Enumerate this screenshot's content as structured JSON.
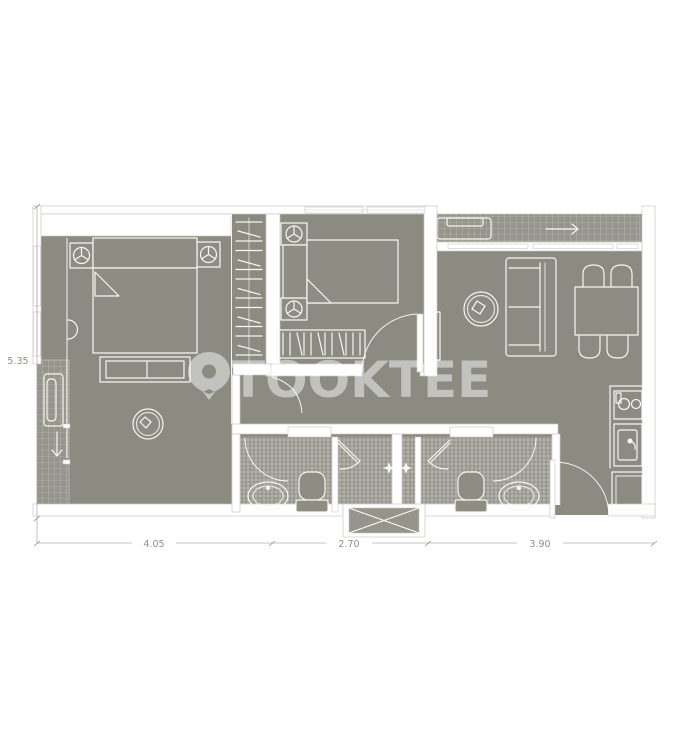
{
  "watermark": {
    "text": "TOOKTEE",
    "icon": "location-pin-icon"
  },
  "dimensions": {
    "left": "5.35",
    "bottom": [
      "4.05",
      "2.70",
      "3.90"
    ]
  },
  "colors": {
    "background": "#ffffff",
    "floor": "#8b8b82",
    "floor_furniture": "#8d8d84",
    "floor_tile": "#95958c",
    "wall_fill": "#ffffff",
    "wall_outline": "#c9c9c2",
    "furniture_line": "#f7f7f4",
    "watermark": "#ffffff",
    "dimension": "#8f8f88"
  },
  "icons": {
    "top_balcony_arrow": "arrow-right-icon",
    "left_balcony_arrow": "arrow-down-icon",
    "watermark_pin": "location-pin-icon"
  }
}
